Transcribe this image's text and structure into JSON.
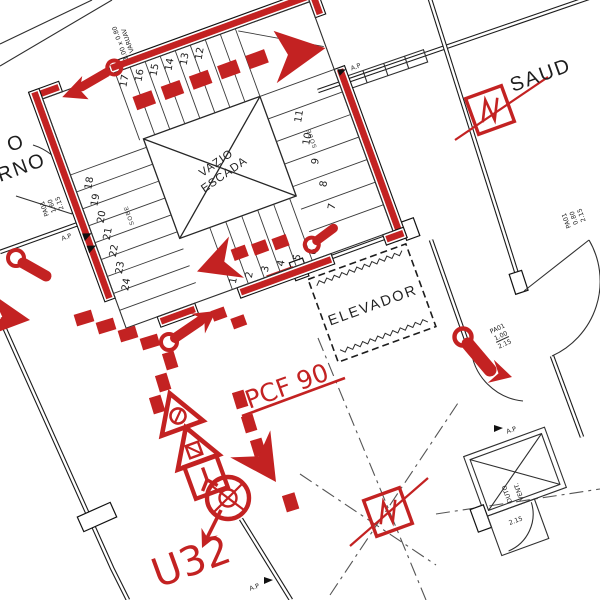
{
  "colors": {
    "route_red": "#c32222",
    "wall_black": "#1c1c1c",
    "line_gray": "#555555"
  },
  "stair": {
    "void_line1": "VAZIO",
    "void_line2": "ESCADA",
    "sobe": "SOBE",
    "top_numbers": [
      "17",
      "16",
      "15",
      "14",
      "13",
      "12"
    ],
    "right_numbers": [
      "11",
      "10",
      "9",
      "8",
      "7"
    ],
    "bottom_numbers": [
      "1",
      "2",
      "3",
      "4",
      "5",
      "6"
    ],
    "left_numbers": [
      "18",
      "19",
      "20",
      "21",
      "22",
      "23",
      "24"
    ]
  },
  "labels": {
    "saud": "SAUD",
    "elevator": "ELEVADOR",
    "pcf90": "PCF 90",
    "u32": "U32",
    "room_left_line1": "O",
    "room_left_line2": "RNO",
    "ap": "A.P",
    "door_left": [
      "PA01",
      "1.60",
      "2.15"
    ],
    "door_lobby": [
      "PA01",
      "1.00",
      "2.15"
    ],
    "door_right": [
      "PA01",
      "0.80",
      "2.15"
    ],
    "duct": [
      "DUTO",
      "VENT.",
      "2.15"
    ],
    "window": [
      "1.00 x 0.80",
      "VARUAV"
    ]
  }
}
